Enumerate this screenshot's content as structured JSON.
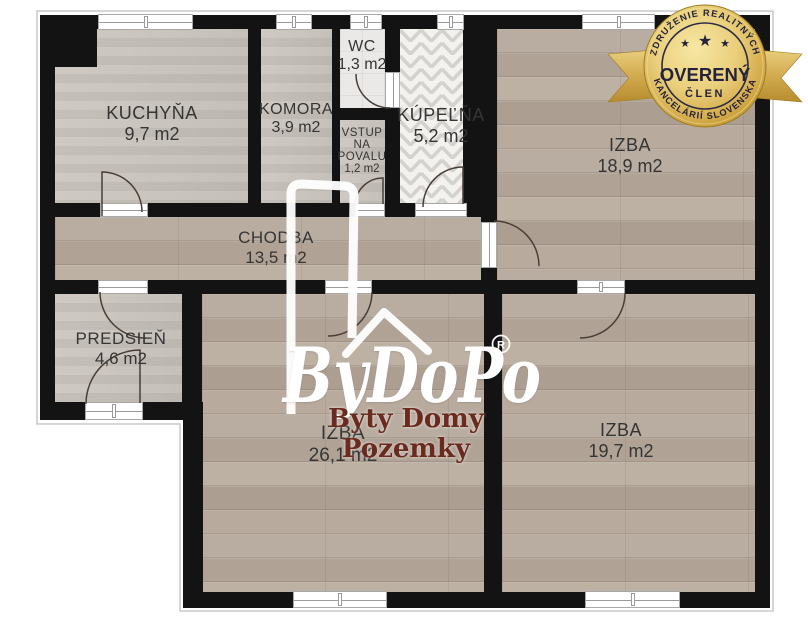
{
  "rooms": [
    {
      "name": "KUCHYŇA",
      "area": "9,7 m2"
    },
    {
      "name": "KOMORA",
      "area": "3,9 m2"
    },
    {
      "name": "WC",
      "area": "1,3 m2"
    },
    {
      "name_lines": [
        "VSTUP",
        "NA",
        "POVALU"
      ],
      "area": "1,2 m2"
    },
    {
      "name": "KÚPEĽŇA",
      "area": "5,2 m2"
    },
    {
      "name": "IZBA",
      "area": "18,9 m2"
    },
    {
      "name": "CHODBA",
      "area": "13,5 m2"
    },
    {
      "name": "PREDSIEŇ",
      "area": "4,6 m2"
    },
    {
      "name": "IZBA",
      "area": "26,1 m2"
    },
    {
      "name": "IZBA",
      "area": "19,7 m2"
    }
  ],
  "watermark": {
    "brand": "ByDoPo",
    "registered": "R",
    "tagline": "Byty Domy Pozemky",
    "tagline_color": "#6b2a1e"
  },
  "badge": {
    "association_top": "ZDRUŽENIE REALITNÝCH",
    "association_bottom": "KANCELÁRIÍ SLOVENSKA",
    "title": "OVERENÝ",
    "member": "ČLEN",
    "star": "★",
    "gold": "#d9b658"
  },
  "colors": {
    "wall": "#131313",
    "wood_floor": "#b5a89b",
    "gray_floor": "#c9c3bc",
    "tile_floor": "#ebe9e7",
    "door_arc": "#4a3f37"
  }
}
